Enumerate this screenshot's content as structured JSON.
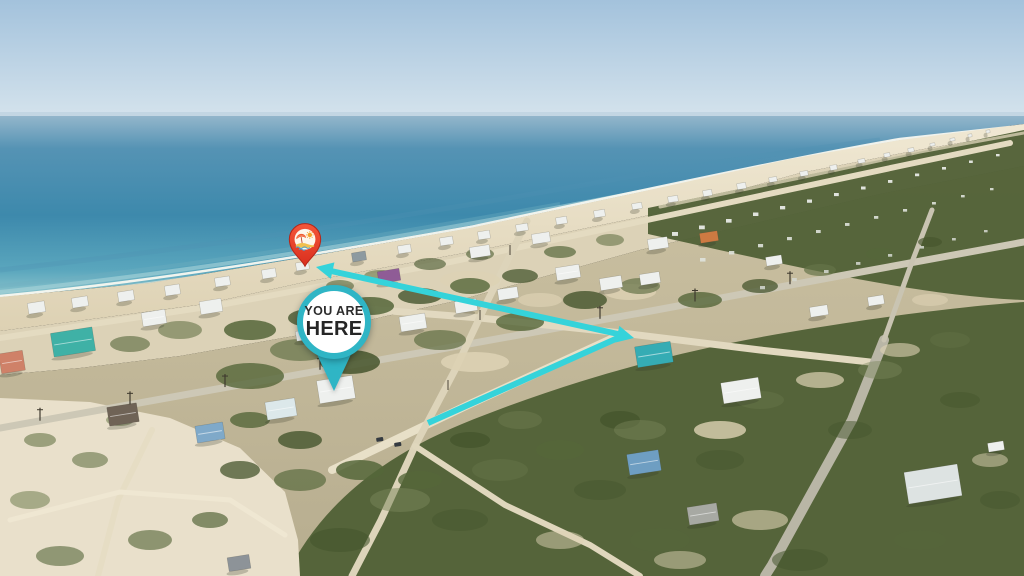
{
  "annotations": {
    "badge": {
      "line1": "YOU ARE",
      "line2": "HERE",
      "ring_color": "#2fb5c5",
      "fill_color": "#ffffff",
      "text_color": "#2c2c2c",
      "center": {
        "x": 334,
        "y": 322
      },
      "pointer_tip": {
        "x": 334,
        "y": 391
      }
    },
    "pin": {
      "icon": "beach-day-icon",
      "body_color": "#e63a28",
      "sun_color": "#f5a12b",
      "umbrella_color": "#ee5a31",
      "sand_color": "#f2c04e",
      "wave_color": "#44a4dc",
      "position": {
        "x": 305,
        "y": 244
      }
    },
    "route": {
      "color": "#35d3da",
      "stroke_width": 6,
      "segments": [
        {
          "from": [
            428,
            423
          ],
          "to": [
            620,
            337
          ]
        },
        {
          "from": [
            618,
            334
          ],
          "to": [
            331,
            271
          ]
        }
      ],
      "arrowheads": [
        {
          "tip": [
            634,
            338
          ],
          "angle_deg": 13
        },
        {
          "tip": [
            316,
            267
          ],
          "angle_deg": 192.3
        }
      ]
    }
  },
  "scene": {
    "description": "oblique aerial photo of a barrier-island beach town: gulf water upper left, white sand beach running diagonally, rows of stilt houses in scrub forest, sandy streets, island receding to horizon at right",
    "palette": {
      "sky": "#a8c6e0",
      "sea_deep": "#3d89ac",
      "sea_shallow": "#8fc6cd",
      "sand": "#e9dfc6",
      "forest": "#55643a",
      "road_sand": "#e4dbc1",
      "road_paved": "#b9b6a6",
      "house_white": "#eef0ee"
    }
  }
}
